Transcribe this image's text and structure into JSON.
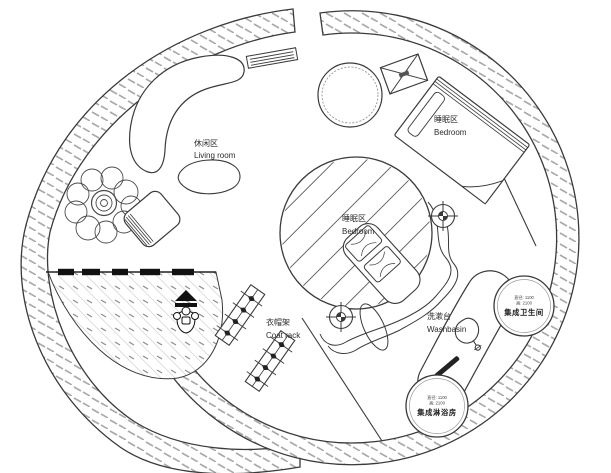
{
  "plan": {
    "type": "circular-house-floor-plan",
    "zones": {
      "living": {
        "zh": "休闲区",
        "en": "Living room"
      },
      "bedroom_upper": {
        "zh": "睡眠区",
        "en": "Bedroom"
      },
      "bedroom_center": {
        "zh": "睡眠区",
        "en": "Bedroom"
      },
      "coat_rack": {
        "zh": "衣帽架",
        "en": "Coat rack"
      },
      "washbasin": {
        "zh": "洗漱台",
        "en": "Washbasin"
      },
      "toilet_pod": {
        "dim1": "直径: 1100",
        "dim2": "高: 2100",
        "name": "集成卫生间"
      },
      "shower_pod": {
        "dim1": "直径: 1100",
        "dim2": "高: 2100",
        "name": "集成淋浴房"
      }
    },
    "icons": [
      "sofa-icon",
      "coffee-table-icon",
      "plant-icon",
      "armchair-icon",
      "wall-grille-icon",
      "round-table-icon",
      "vent-box-icon",
      "bed-icon",
      "pillow-bed-icon",
      "column-target-icon",
      "coat-rack-icon",
      "basin-icon",
      "towel-bar-icon",
      "person-icon",
      "entry-arrow-icon"
    ],
    "colors": {
      "line": "#3a3a3a",
      "dark": "#111111",
      "wall_hatch": "#a9a9a9",
      "floor_hatch_light": "#d9d9d9",
      "floor_hatch_dark": "#8f8f8f",
      "background": "#ffffff"
    }
  }
}
